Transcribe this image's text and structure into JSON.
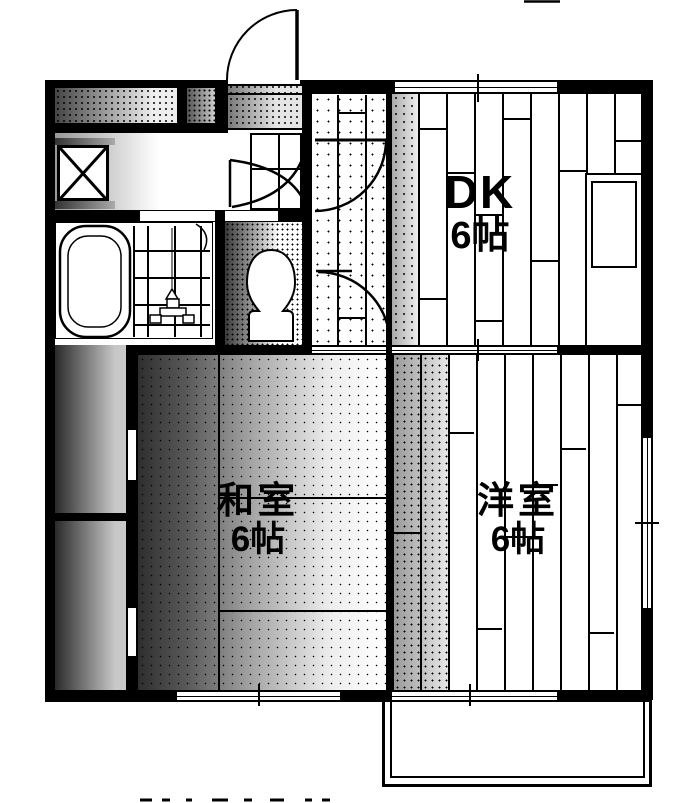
{
  "plan_title": "apartment-floor-plan",
  "rooms": [
    {
      "id": "dk",
      "name": "DK",
      "size": "6帖"
    },
    {
      "id": "washitsu",
      "name": "和室",
      "size": "6帖"
    },
    {
      "id": "youshitsu",
      "name": "洋室",
      "size": "6帖"
    }
  ],
  "fixtures": {
    "bathtub": "bathtub",
    "shower_area": "tiled-washing-area-with-faucet",
    "toilet": "toilet",
    "washing_machine_pan": "washing-machine-pan",
    "vanity": "wash-basin-counter",
    "kitchen_counter": "kitchen-counter-with-sink",
    "entrance_door": "entrance-swing-door",
    "hall_doors": "two-interior-swing-doors",
    "closet": "oshiire-closet-two-sections",
    "balcony": "balcony",
    "windows": "sliding-windows-top-right-bottom"
  },
  "colors": {
    "ink": "#000000",
    "paper": "#ffffff"
  }
}
